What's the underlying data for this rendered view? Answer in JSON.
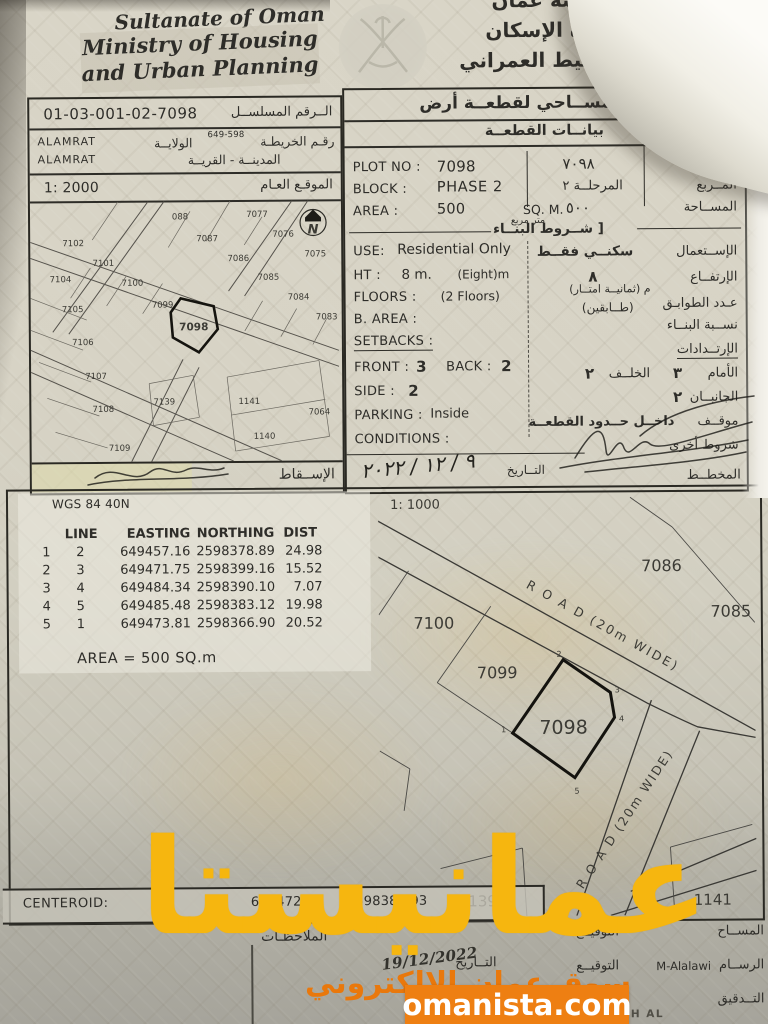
{
  "header": {
    "country_en": "Sultanate of Oman",
    "ministry_en_line1": "Ministry of Housing",
    "ministry_en_line2": "and Urban Planning",
    "country_ar": "سلطنة عمان",
    "ministry_ar_line1": "وزارة الإسكان",
    "ministry_ar_line2": "والتخطيط العمراني"
  },
  "ref_box": {
    "serial_value": "01-03-001-02-7098",
    "serial_label_ar": "الــرقم المسلســل",
    "map_no_value": "649-598",
    "map_label_ar": "رقـم الخريطـة",
    "wilaya_label_ar": "الولايــة",
    "city_label_ar": "المدينــة - القريــة",
    "wilaya_value": "ALAMRAT",
    "city_value": "ALAMRAT",
    "scale_value": "1: 2000",
    "site_label_ar": "الموقـع العـام",
    "projection_label_ar": "الإســقاط"
  },
  "overview_map": {
    "north_label": "N",
    "labels": [
      "088",
      "7077",
      "7087",
      "7076",
      "7102",
      "7086",
      "7101",
      "7075",
      "7104",
      "7100",
      "7085",
      "7105",
      "7099",
      "7084",
      "7098",
      "7083",
      "7106",
      "7107",
      "7139",
      "1141",
      "7108",
      "7064",
      "1140",
      "7109"
    ]
  },
  "survey_box": {
    "title_ar": "رســم مســاحي لقطعــة أرض",
    "subtitle_ar": "بيانــات القطعــة",
    "english": {
      "plot_no_label": "PLOT NO :",
      "plot_no": "7098",
      "block_label": "BLOCK :",
      "block": "PHASE 2",
      "area_label": "AREA :",
      "area": "500",
      "area_unit": "SQ. M.",
      "use_label": "USE:",
      "use": "Residential Only",
      "ht_label": "HT :",
      "ht": "8 m.",
      "ht_note": "(Eight)m",
      "floors_label": "FLOORS :",
      "floors": "(2 Floors)",
      "b_area_label": "B. AREA :",
      "setbacks_label": "SETBACKS :",
      "front_label": "FRONT :",
      "front": "3",
      "back_label": "BACK :",
      "back": "2",
      "side_label": "SIDE :",
      "side": "2",
      "parking_label": "PARKING :",
      "parking": "Inside",
      "conditions_label": "CONDITIONS :"
    },
    "arabic": {
      "plot_label": "القطعــة",
      "plot_value": "٧٠٩٨",
      "block_label": "المــربع",
      "block_value": "المرحلــة ٢",
      "area_label": "المســاحة",
      "area_value": "٥٠٠",
      "area_unit": "متر مربع",
      "conditions_title": "[ شــروط البنــاء",
      "use_label": "الإســتعمال",
      "use_value": "سكنــي فقــط",
      "height_label": "الإرتفــاع",
      "height_value": "٨",
      "height_note": "م  (ثمانيــة امتــار)",
      "floors_label": "عـدد الطوابـق",
      "floors_value": "(طــابقين)",
      "ratio_label": "نســبة البنــاء",
      "setbacks_title": "الإرتــدادات",
      "front_label": "الأمام",
      "front_value": "٣",
      "back_label": "الخلــف",
      "back_value": "٢",
      "sides_label": "الجانبــان",
      "sides_value": "٢",
      "parking_label": "موقــف",
      "parking_value": "داخــل حــدود القطعــة",
      "other_label": "شروط أخرى",
      "planner_label": "المخطــط",
      "date_label": "التــاريخ",
      "date_value": "٩ / ١٢ / ٢٠٢٢"
    }
  },
  "coords_table": {
    "datum": "WGS 84  40N",
    "col_line": "LINE",
    "col_easting": "EASTING",
    "col_northing": "NORTHING",
    "col_dist": "DIST",
    "rows": [
      {
        "a": "1",
        "b": "2",
        "easting": "649457.16",
        "northing": "2598378.89",
        "dist": "24.98"
      },
      {
        "a": "2",
        "b": "3",
        "easting": "649471.75",
        "northing": "2598399.16",
        "dist": "15.52"
      },
      {
        "a": "3",
        "b": "4",
        "easting": "649484.34",
        "northing": "2598390.10",
        "dist": "7.07"
      },
      {
        "a": "4",
        "b": "5",
        "easting": "649485.48",
        "northing": "2598383.12",
        "dist": "19.98"
      },
      {
        "a": "5",
        "b": "1",
        "easting": "649473.81",
        "northing": "2598366.90",
        "dist": "20.52"
      }
    ],
    "area_note": "AREA = 500  SQ.m"
  },
  "detail_map": {
    "scale": "1: 1000",
    "road_label_1": "R O A D   (20m WIDE)",
    "road_label_2": "R O A D  (20m WIDE)",
    "plots": [
      "7086",
      "7085",
      "7100",
      "7099",
      "7098",
      "7139",
      "1141"
    ],
    "vertices": [
      "1",
      "2",
      "3",
      "4",
      "5"
    ]
  },
  "footer": {
    "centeroid_label": "CENTEROID:",
    "centeroid_easting": "649472.44",
    "centeroid_northing": "2598382.93",
    "notes_label_ar": "الملاحظـات",
    "rows": [
      {
        "role_ar": "المســاح",
        "name": "",
        "sig_ar": "التوقيــع"
      },
      {
        "role_ar": "الرســام",
        "name": "M-Alalawi",
        "sig_ar": "التوقيــع"
      },
      {
        "role_ar": "التــدقيق",
        "name": "",
        "sig_ar": "التوقيــع"
      }
    ],
    "date_label_ar": "التــاريخ",
    "date_value": "19/12/2022",
    "approver_partial": "MAHFOUDH AL"
  },
  "watermark": {
    "main_text": "عمانيستا",
    "sub_text": "سوق عمان الإلكتروني",
    "badge_text": "omanista.com",
    "yellow": "#f6b60f",
    "orange": "#e9780c"
  }
}
